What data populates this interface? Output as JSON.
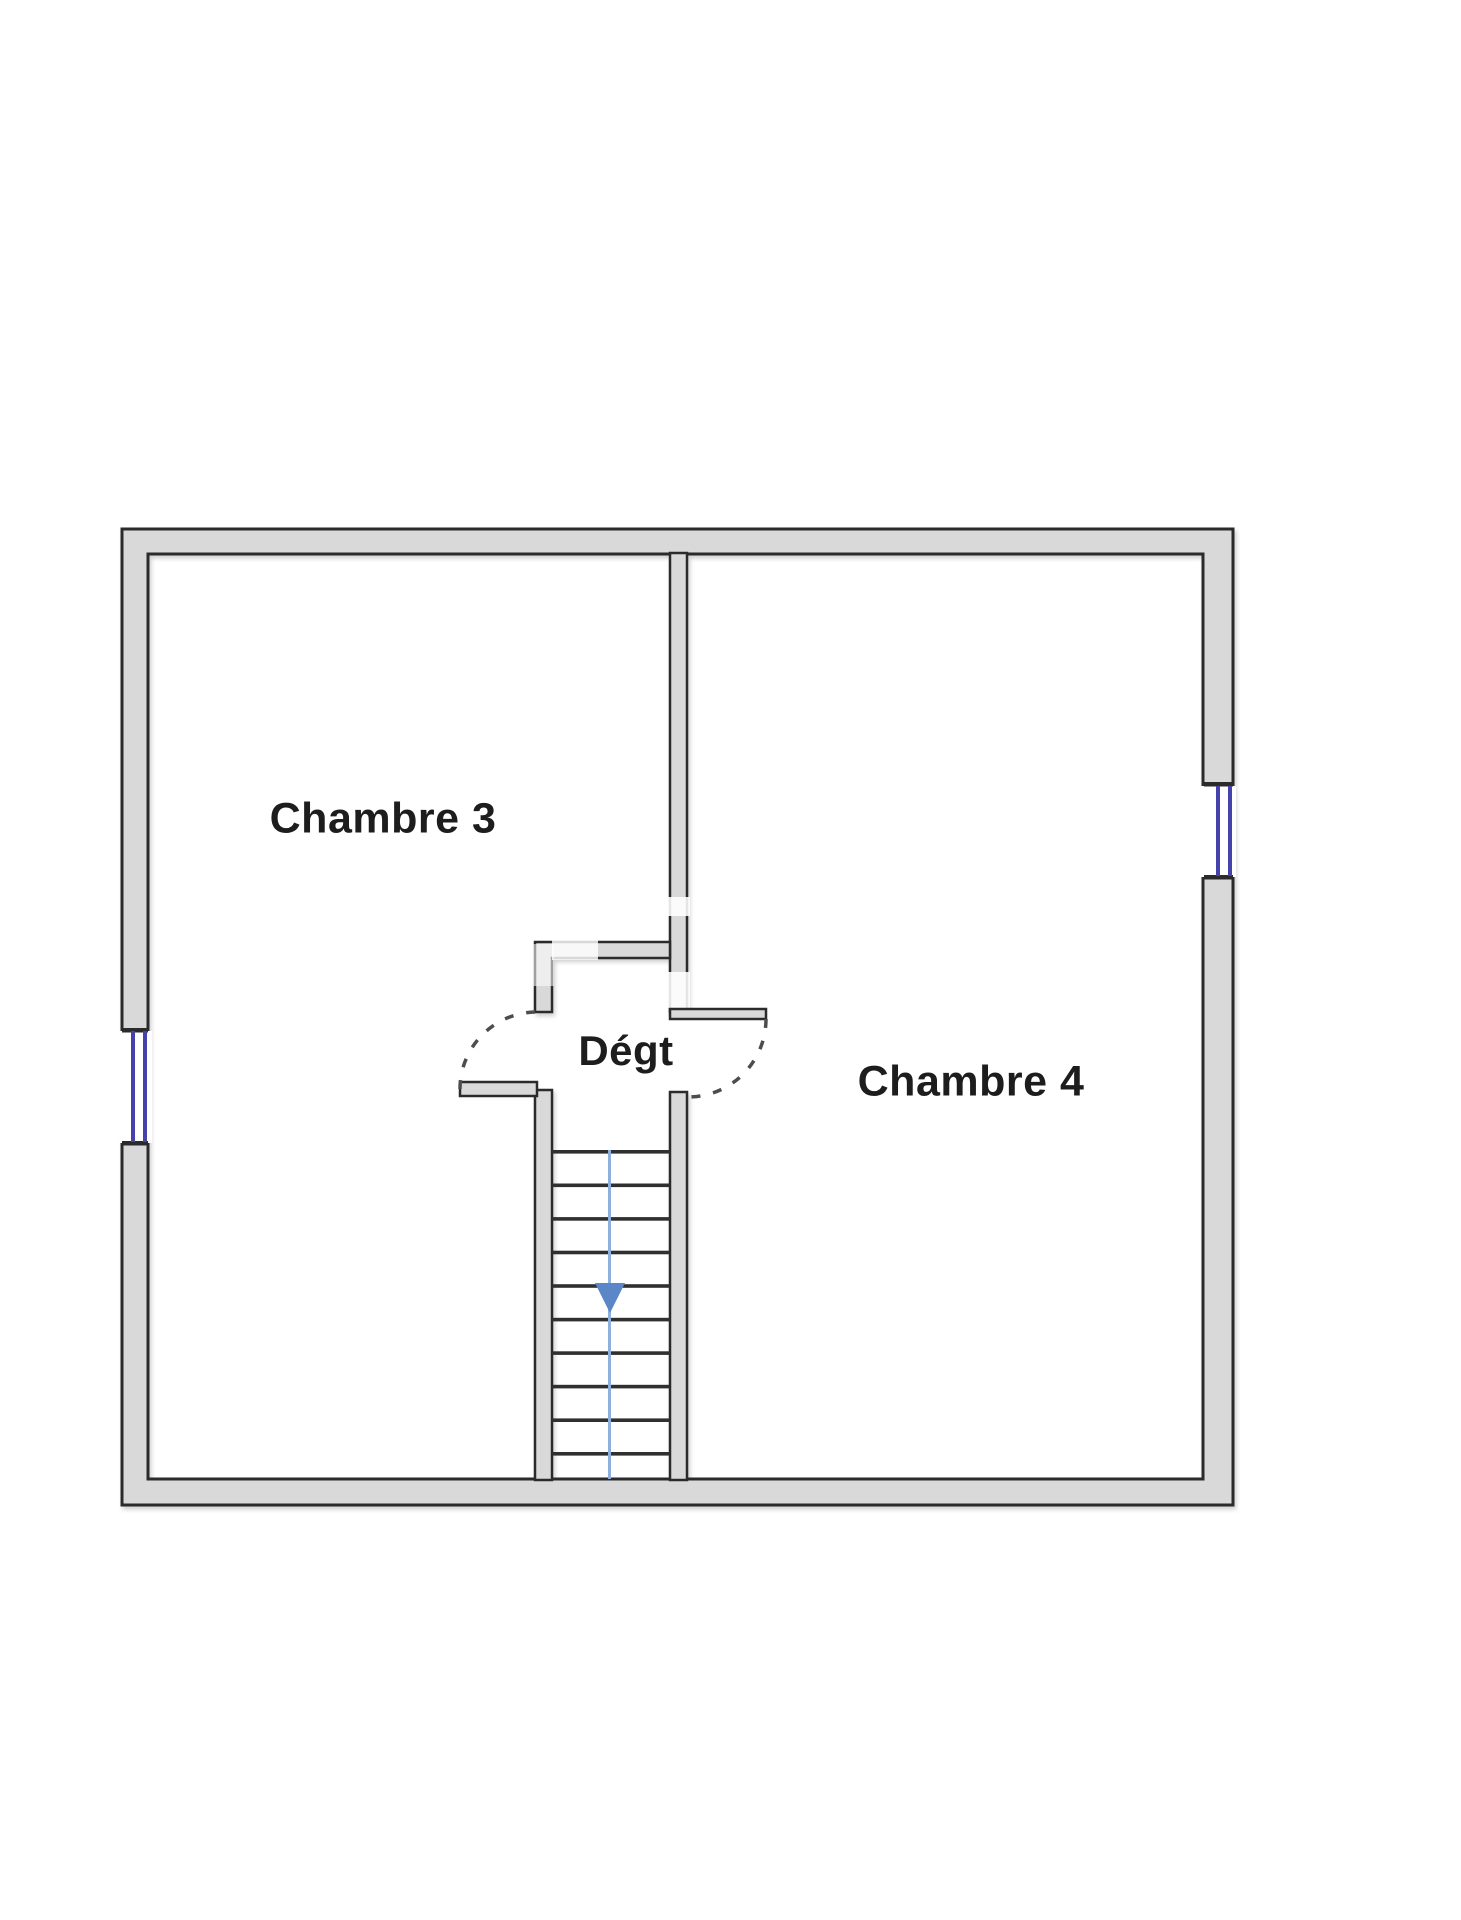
{
  "floorplan": {
    "type": "floor-plan",
    "rooms": [
      {
        "label": "Chambre 3"
      },
      {
        "label": "Chambre 4"
      },
      {
        "label": "Dégt"
      }
    ],
    "stairs": {
      "steps": 10,
      "direction": "down"
    },
    "features": {
      "windows": 2,
      "doors": 2
    },
    "colors": {
      "wall_fill": "#d9d9d9",
      "wall_outline": "#2b2b2b",
      "window_frame_blue": "#4543ab",
      "stair_arrow_blue": "#5b86c8",
      "stair_guide_blue": "#8fb0dc",
      "door_swing_gray": "#4d4d4d"
    }
  }
}
